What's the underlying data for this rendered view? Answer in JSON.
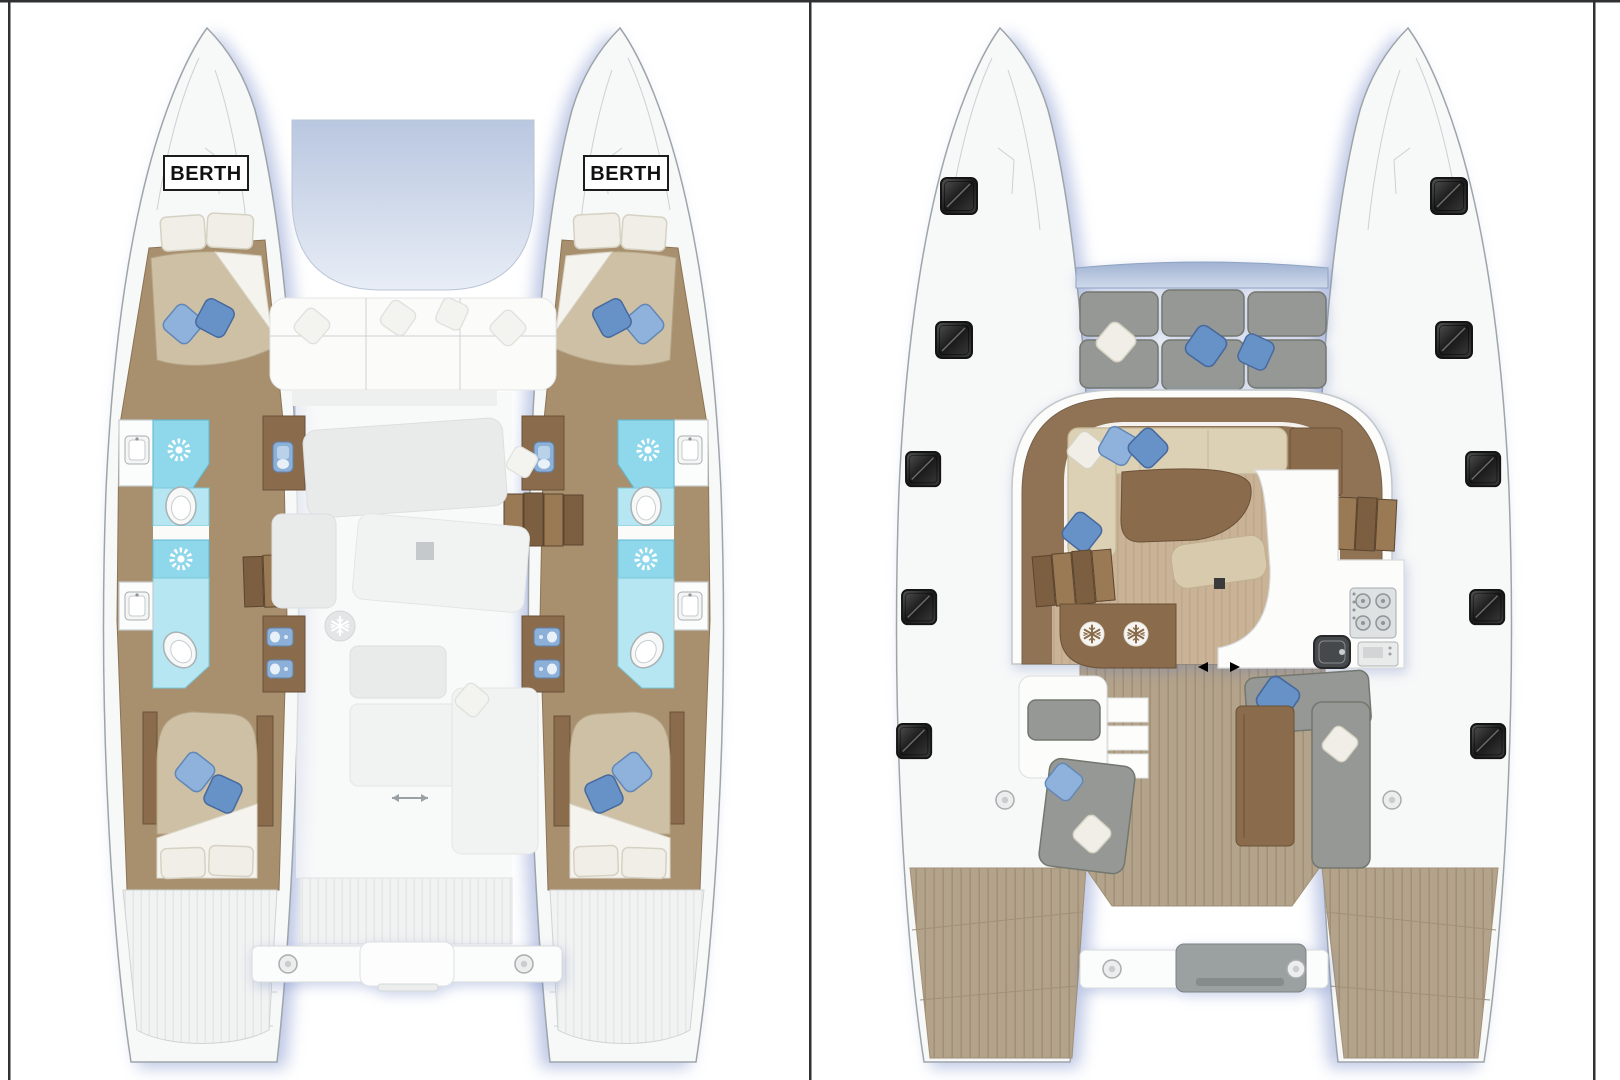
{
  "page": {
    "background": "#ffffff"
  },
  "colors": {
    "page": "#ffffff",
    "frame": "#2f3133",
    "hull_white": "#f7f8f8",
    "shower_cyan": "#8fd7ea",
    "wood_floor": "#a8906f",
    "wood_dark": "#8a6c4c",
    "teak_deck": "#b3a38b",
    "mattress_beige": "#cec0a5",
    "pillow_blue": "#6792c8",
    "cushion_gray": "#959894",
    "saloon_floor_brown": "#8f7354",
    "hatch_dark": "#2b2b2b",
    "accent_red": "#b31312"
  },
  "cabin_deck_plan": {
    "berth_label_port": "BERTH",
    "berth_label_starboard": "BERTH",
    "features": [
      "double-berth-forward",
      "shower-icon",
      "toilet-icon",
      "vanity-sink-icon",
      "companionway-stairs",
      "double-berth-aft",
      "blue-pillows",
      "ghosted-saloon-furniture",
      "fridge-snowflake-icon",
      "transom-crossbeam",
      "swim-steps"
    ]
  },
  "main_deck_plan": {
    "features": [
      "deck-hatch-icon",
      "bow-lounge-seating",
      "saloon-l-sofa",
      "dining-table",
      "coffee-table",
      "galley-stove-icon",
      "galley-sink-icon",
      "oven-icon",
      "fridge-snowflake-icon",
      "companionway-stairs",
      "sliding-door-arrow-icon",
      "cockpit-sofas",
      "cockpit-table",
      "helm-seat",
      "round-deck-fitting-icon",
      "swim-platforms"
    ]
  }
}
